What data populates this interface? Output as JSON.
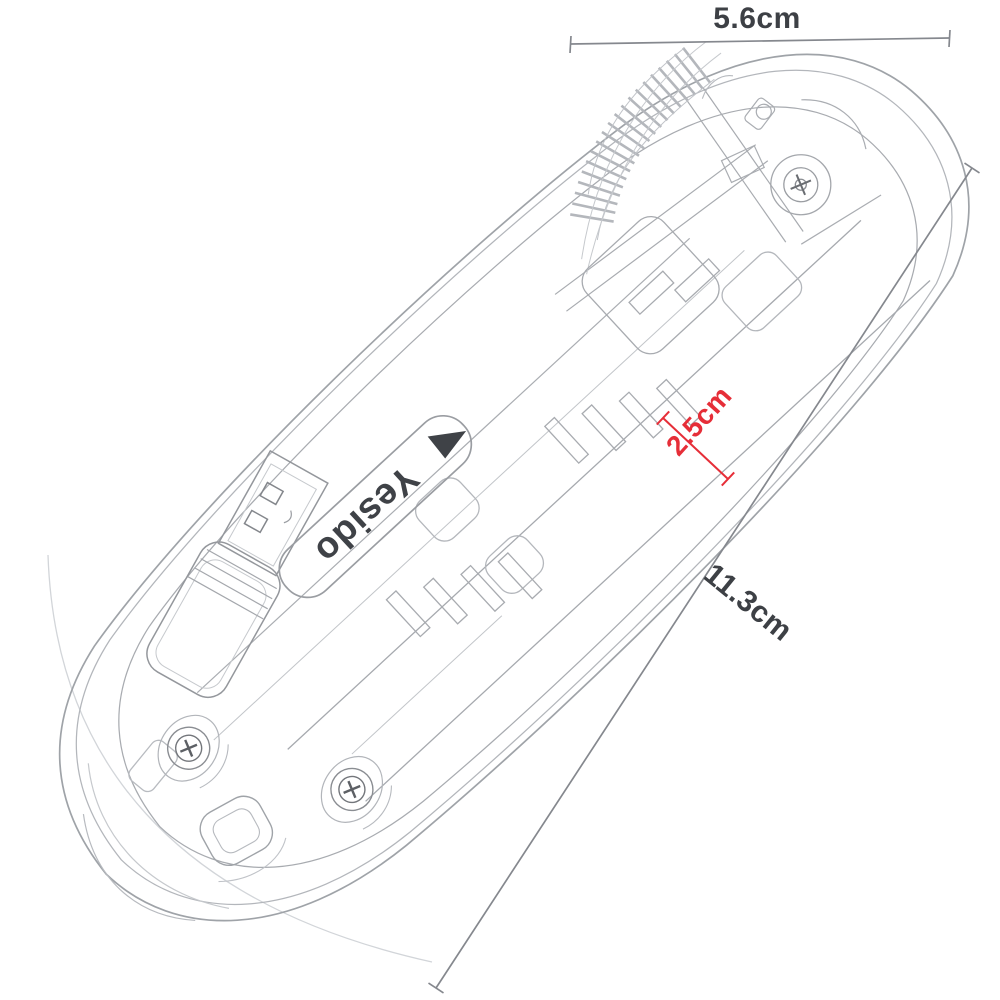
{
  "product": {
    "brand": "Yesido"
  },
  "dimensions": {
    "width": {
      "value": "5.6cm"
    },
    "length": {
      "value": "11.3cm"
    },
    "height": {
      "value": "2.5cm"
    }
  },
  "colors": {
    "background": "#ffffff",
    "drawing_line": "#aaadb2",
    "outline": "#9fa3a8",
    "dimension_line": "#85888e",
    "label_text": "#3d4045",
    "accent": "#e62e38",
    "brand_text": "#3f4247"
  }
}
